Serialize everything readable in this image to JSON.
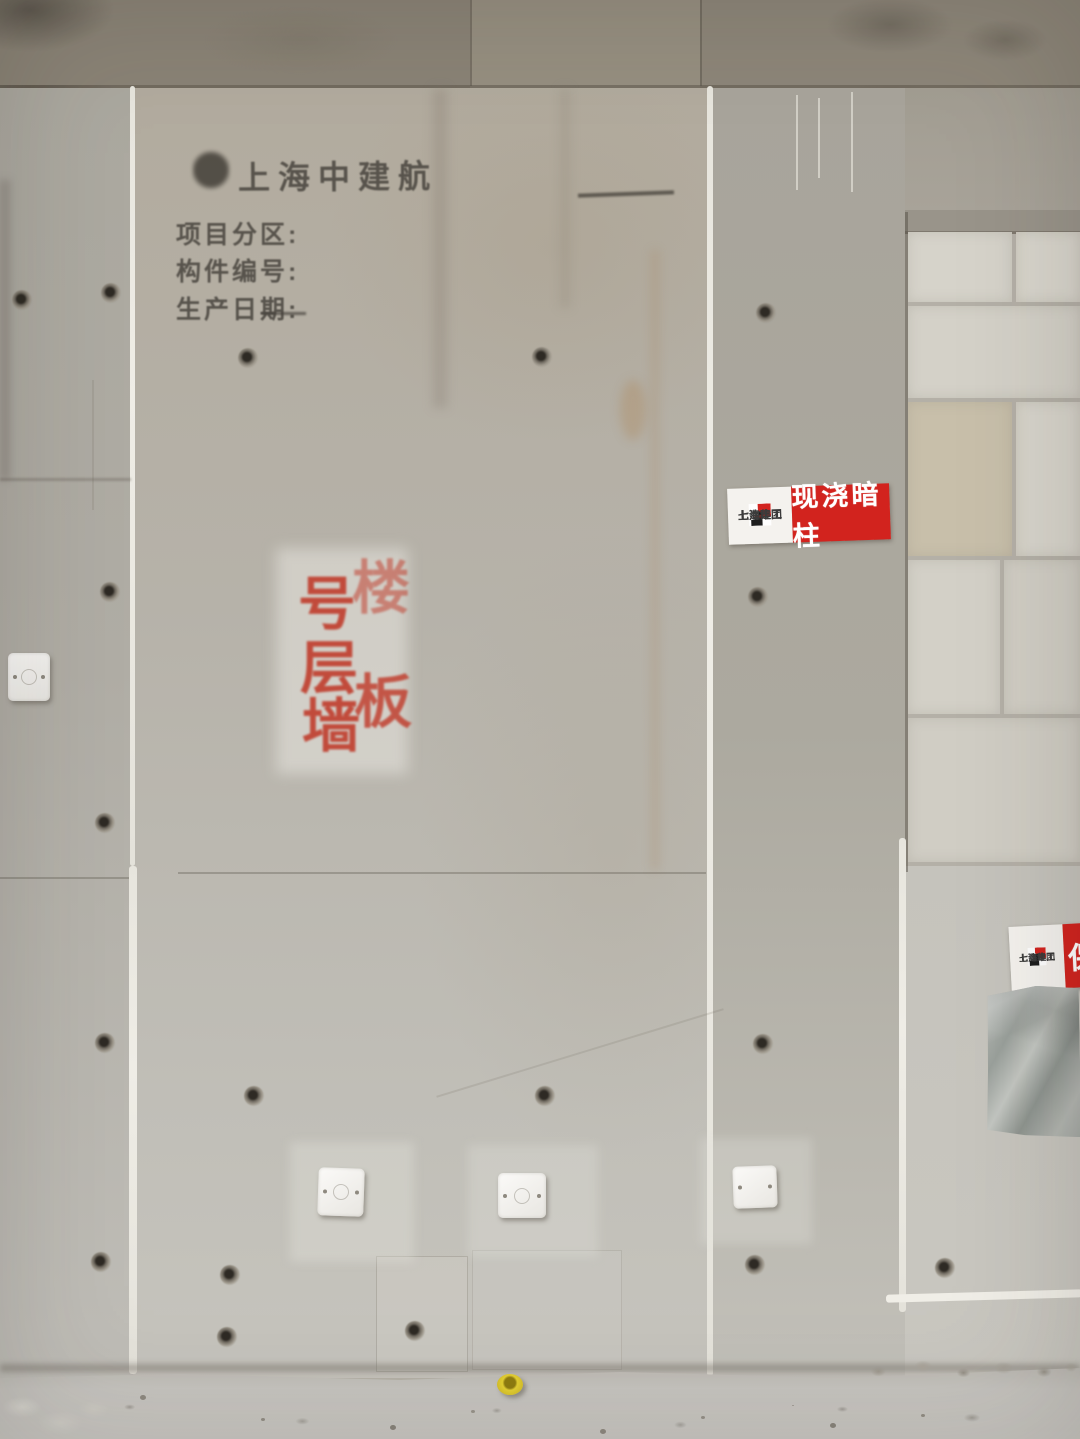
{
  "wall_stencil": {
    "logo_icon": "zhongjianhang-stamp-logo",
    "title": "上海中建航",
    "fields": [
      {
        "label": "项目分区:"
      },
      {
        "label": "构件编号:"
      },
      {
        "label": "生产日期:"
      }
    ]
  },
  "spray_stencil": {
    "color": "#bf3423",
    "chars": [
      "号",
      "楼",
      "层",
      "墙",
      "板"
    ]
  },
  "signs": {
    "cast_column_sign": {
      "company_line1": "上海建工",
      "company_line2": "七建集团",
      "title": "现浇暗柱",
      "red": "#d2231e"
    },
    "partial_sign": {
      "company_line1": "上海建工",
      "company_line2": "七建集团",
      "title_partial": "保"
    }
  },
  "features": {
    "tie_holes": [
      [
        248,
        358
      ],
      [
        542,
        357
      ],
      [
        766,
        313
      ],
      [
        111,
        293
      ],
      [
        22,
        300
      ],
      [
        110,
        592
      ],
      [
        758,
        597
      ],
      [
        105,
        823
      ],
      [
        105,
        1043
      ],
      [
        254,
        1096
      ],
      [
        545,
        1096
      ],
      [
        763,
        1044
      ],
      [
        945,
        1268
      ],
      [
        101,
        1262
      ],
      [
        230,
        1275
      ],
      [
        227,
        1337
      ],
      [
        415,
        1331
      ],
      [
        755,
        1265
      ]
    ]
  },
  "colors": {
    "wall": "#b4b0a7",
    "ceiling": "#8e8779",
    "seam_white": "#efede6",
    "block": "#d6d3ca",
    "sign_red": "#d2231e",
    "stencil_black": "#44403a",
    "foil": "#a9ada8",
    "cap_yellow": "#e3cf31",
    "floor": "#c7c5c0"
  }
}
